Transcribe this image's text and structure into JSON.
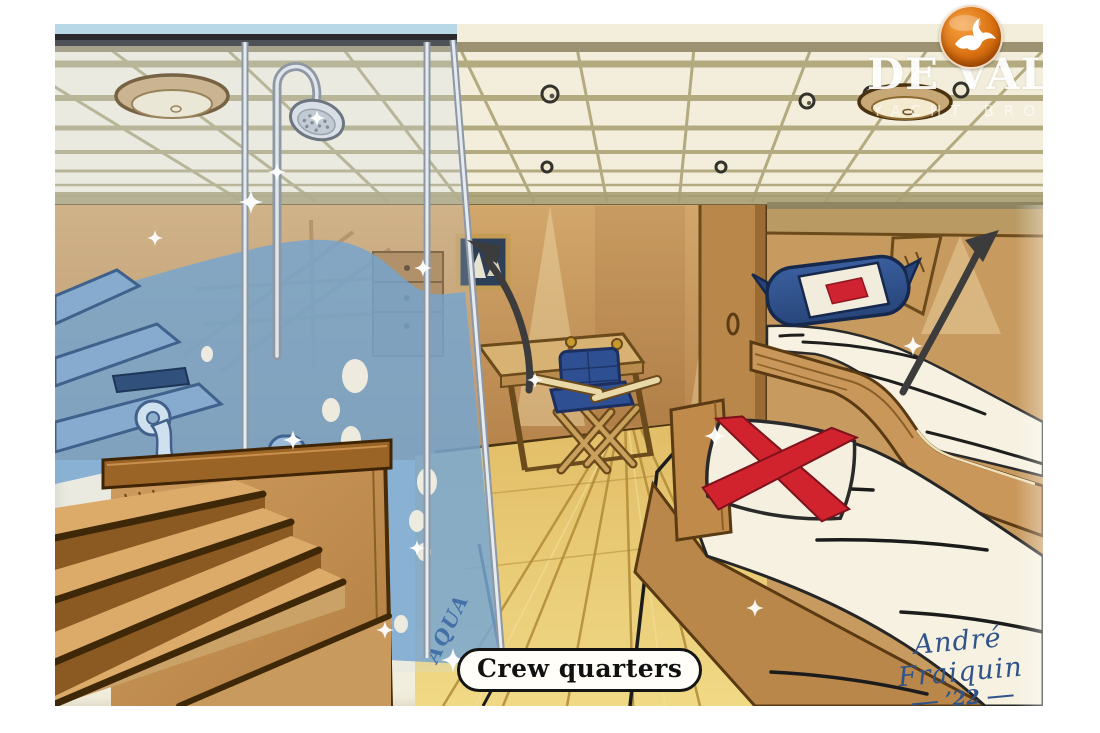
{
  "illustration": {
    "caption": "Crew quarters",
    "glass_doodle": "AQUA",
    "signature": {
      "artist": "André Fraiquin",
      "year": "’22"
    },
    "logo": {
      "brand": "DE VALK",
      "tagline": "YACHT BROKERS"
    },
    "palette": {
      "paper_cream": "#f2eedd",
      "ceiling_grid_khaki": "#b4aa80",
      "wall_tan": "#c79a5f",
      "wood_dark_outline": "#5a3a12",
      "wood_mid": "#c08a4a",
      "stair_tread": "#dcab6a",
      "floor_gold": "#ecd27c",
      "glass_water_blue": "#74a5cf",
      "behind_glass_blue": "#41618c",
      "cushion_blue": "#2e4f91",
      "pillow_navy": "#2b4a7e",
      "signal_red": "#d0232e",
      "mattress_white": "#f6f1e0",
      "arrow_gray": "#3c3c3c",
      "signature_blue": "#30548a",
      "logo_orange": "#da7110",
      "chrome": "#c7cdd5"
    },
    "depicted_objects": [
      "ceiling spotlights",
      "dome ceiling lights",
      "glass shower cabin with rain shower head",
      "steamed glass with soap bubbles",
      "toilet paper roll and drain behind glass",
      "wooden staircase with balustrade",
      "writing desk",
      "blue director's chair",
      "two cabin hatch doors",
      "framed ship painting",
      "upper and lower bunk beds",
      "pillow with red saltire signal flag",
      "blue pillow with signal flag",
      "direction arrows"
    ]
  }
}
